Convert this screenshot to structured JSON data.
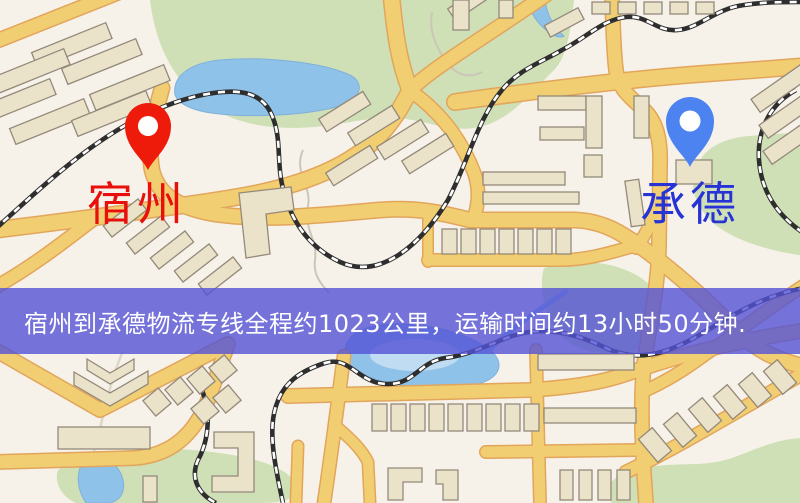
{
  "map": {
    "type": "stylized-city-map",
    "markers": [
      {
        "id": "origin",
        "label": "宿州",
        "pin_icon": "red-map-pin",
        "pin_color": "#ee1b0b",
        "label_color": "#e8100a"
      },
      {
        "id": "destination",
        "label": "承德",
        "pin_icon": "blue-map-pin",
        "pin_color": "#4c83f1",
        "label_color": "#2733d4"
      }
    ],
    "colors": {
      "background": "#f7f2e9",
      "road_fill": "#f2ce72",
      "road_casing": "#e2a55c",
      "park_green": "#cfe0b6",
      "water_blue": "#8fc2e8",
      "building_fill": "#ebe2ca",
      "railway_dark": "#2e2e2e"
    }
  },
  "banner": {
    "text": "宿州到承德物流专线全程约1023公里，运输时间约13小时50分钟.",
    "bg_color": "#5453d6",
    "text_color": "#ffffff",
    "distance_km": 1023,
    "duration": "13小时50分钟"
  }
}
